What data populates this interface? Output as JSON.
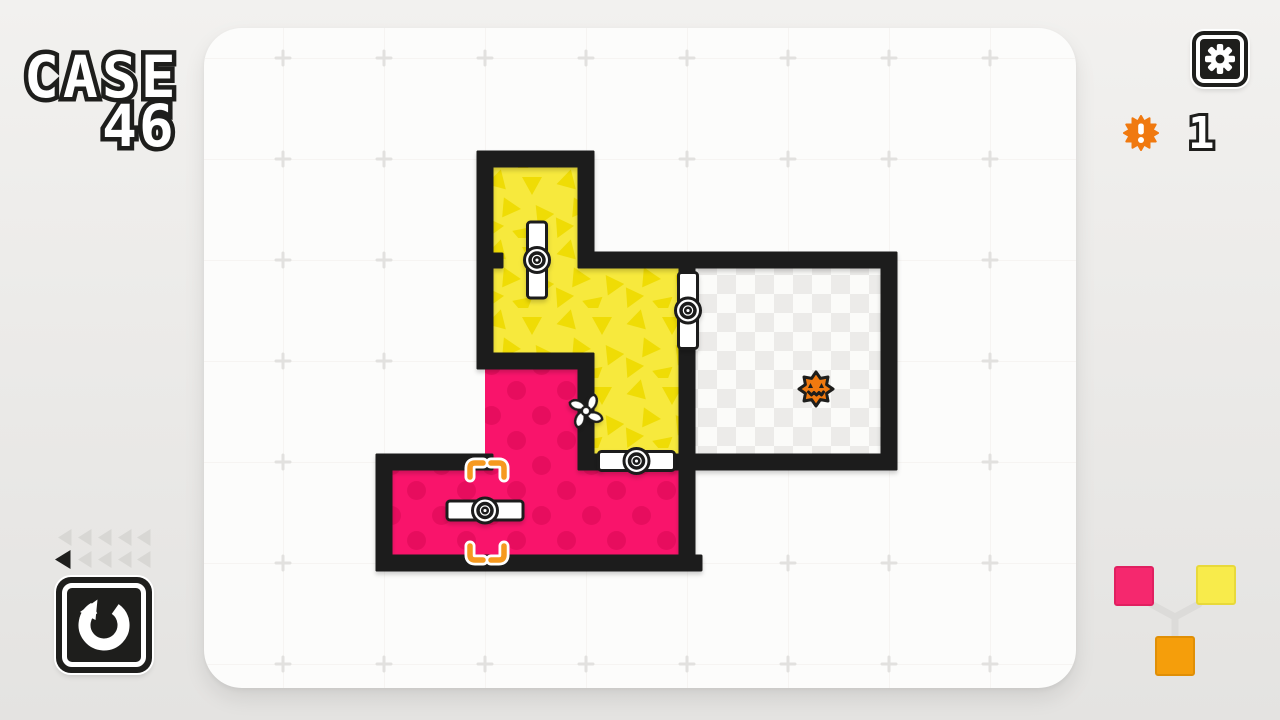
{
  "hud": {
    "case_label": "CASE",
    "case_number": "46",
    "suspect_counter": {
      "count": "1",
      "icon": "spiky-alert-icon"
    },
    "undo_steps": {
      "rows": 2,
      "per_row": 5,
      "active_steps": 1
    }
  },
  "level": {
    "rooms": [
      {
        "id": "yellow-room",
        "color": "yellow",
        "pattern": "triangles",
        "state": "revealed"
      },
      {
        "id": "pink-room",
        "color": "pink",
        "pattern": "dots",
        "state": "revealed"
      },
      {
        "id": "unknown-room",
        "pattern": "checkerboard",
        "state": "unrevealed",
        "contains": "suspect"
      }
    ],
    "doors": [
      {
        "id": "door-top-vertical",
        "orientation": "vertical",
        "open": true
      },
      {
        "id": "door-right-vertical",
        "orientation": "vertical",
        "open": true
      },
      {
        "id": "door-middle-horizontal",
        "orientation": "horizontal",
        "open": true
      },
      {
        "id": "door-bottom-horizontal",
        "orientation": "horizontal",
        "open": true,
        "target_brackets": true
      }
    ],
    "pinwheel_doors": 1,
    "suspects_remaining": 1,
    "color_mix_diagram": {
      "inputs": [
        "pink",
        "yellow"
      ],
      "output": "orange"
    }
  },
  "theme": {
    "wall": "#1E1E1C",
    "panel": "#FCFCFB",
    "bg_top": "#F2F1EF",
    "bg_bottom": "#E4E3E1",
    "yellow": "#F7E93D",
    "yellow_tri": "#EFDC05",
    "pink": "#F9146B",
    "pink_dot": "#E70D5E",
    "checker_a": "#ECEBE9",
    "checker_b": "#FBFBF9",
    "door": "#FFFFFF",
    "orange": "#F0790F",
    "bracket": "#F6991F",
    "swatch_pink": "#F5286E",
    "swatch_yellow": "#F8EB4B",
    "swatch_orange": "#F59E0B",
    "connector": "#DCDBD9",
    "tri_gray": "#D8D7D4",
    "tri_dark": "#1E1E1C",
    "grid_line": "#F3F2F0",
    "grid_cross": "#E2E1DF",
    "logo_fill": "#FFFFFF",
    "logo_stroke": "#1E1E1C"
  }
}
